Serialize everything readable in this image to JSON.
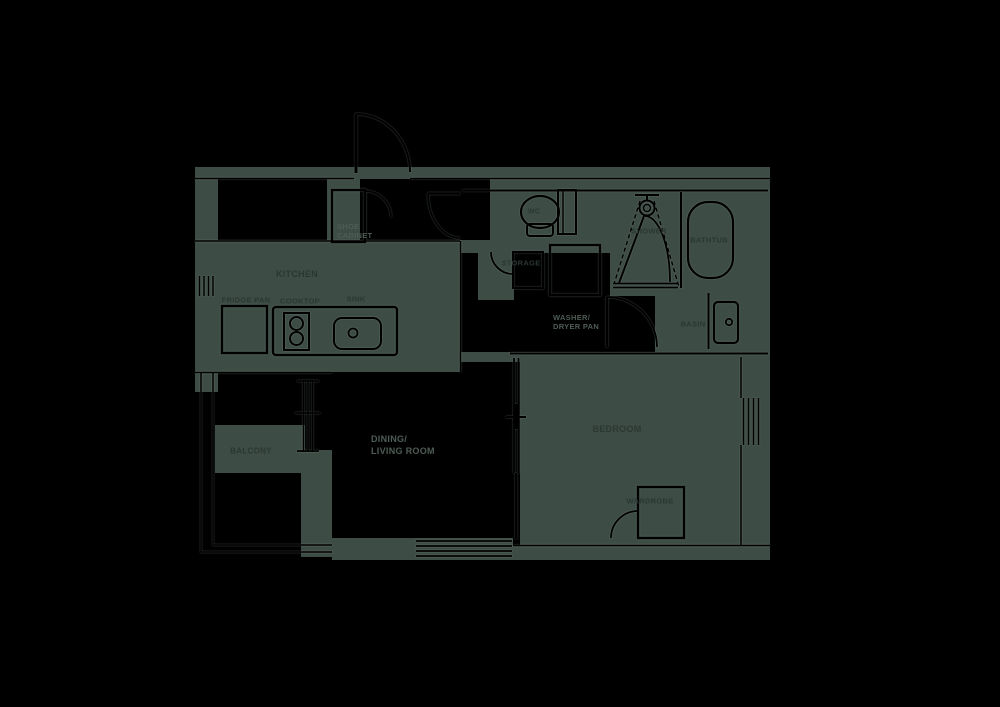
{
  "title": "Apartment floor plan",
  "colors": {
    "background": "#000000",
    "floor_patch": "#3e4c46",
    "line": "#000000",
    "label_on_gray": "#2b3732",
    "label_on_black": "#4e5d55"
  },
  "labels": {
    "kitchen": "KITCHEN",
    "fridge_pan": "FRIDGE PAN",
    "cooktop": "COOKTOP",
    "sink": "SINK",
    "shoe_cabinet_line1": "SHOE",
    "shoe_cabinet_line2": "CABINET",
    "wc": "WC",
    "storage": "STORAGE",
    "washer_line1": "WASHER/",
    "washer_line2": "DRYER PAN",
    "shower": "SHOWER",
    "bathtub": "BATHTUB",
    "basin": "BASIN",
    "balcony": "BALCONY",
    "dining_line1": "DINING/",
    "dining_line2": "LIVING ROOM",
    "bedroom": "BEDROOM",
    "wardrobe": "WARDROBE"
  }
}
